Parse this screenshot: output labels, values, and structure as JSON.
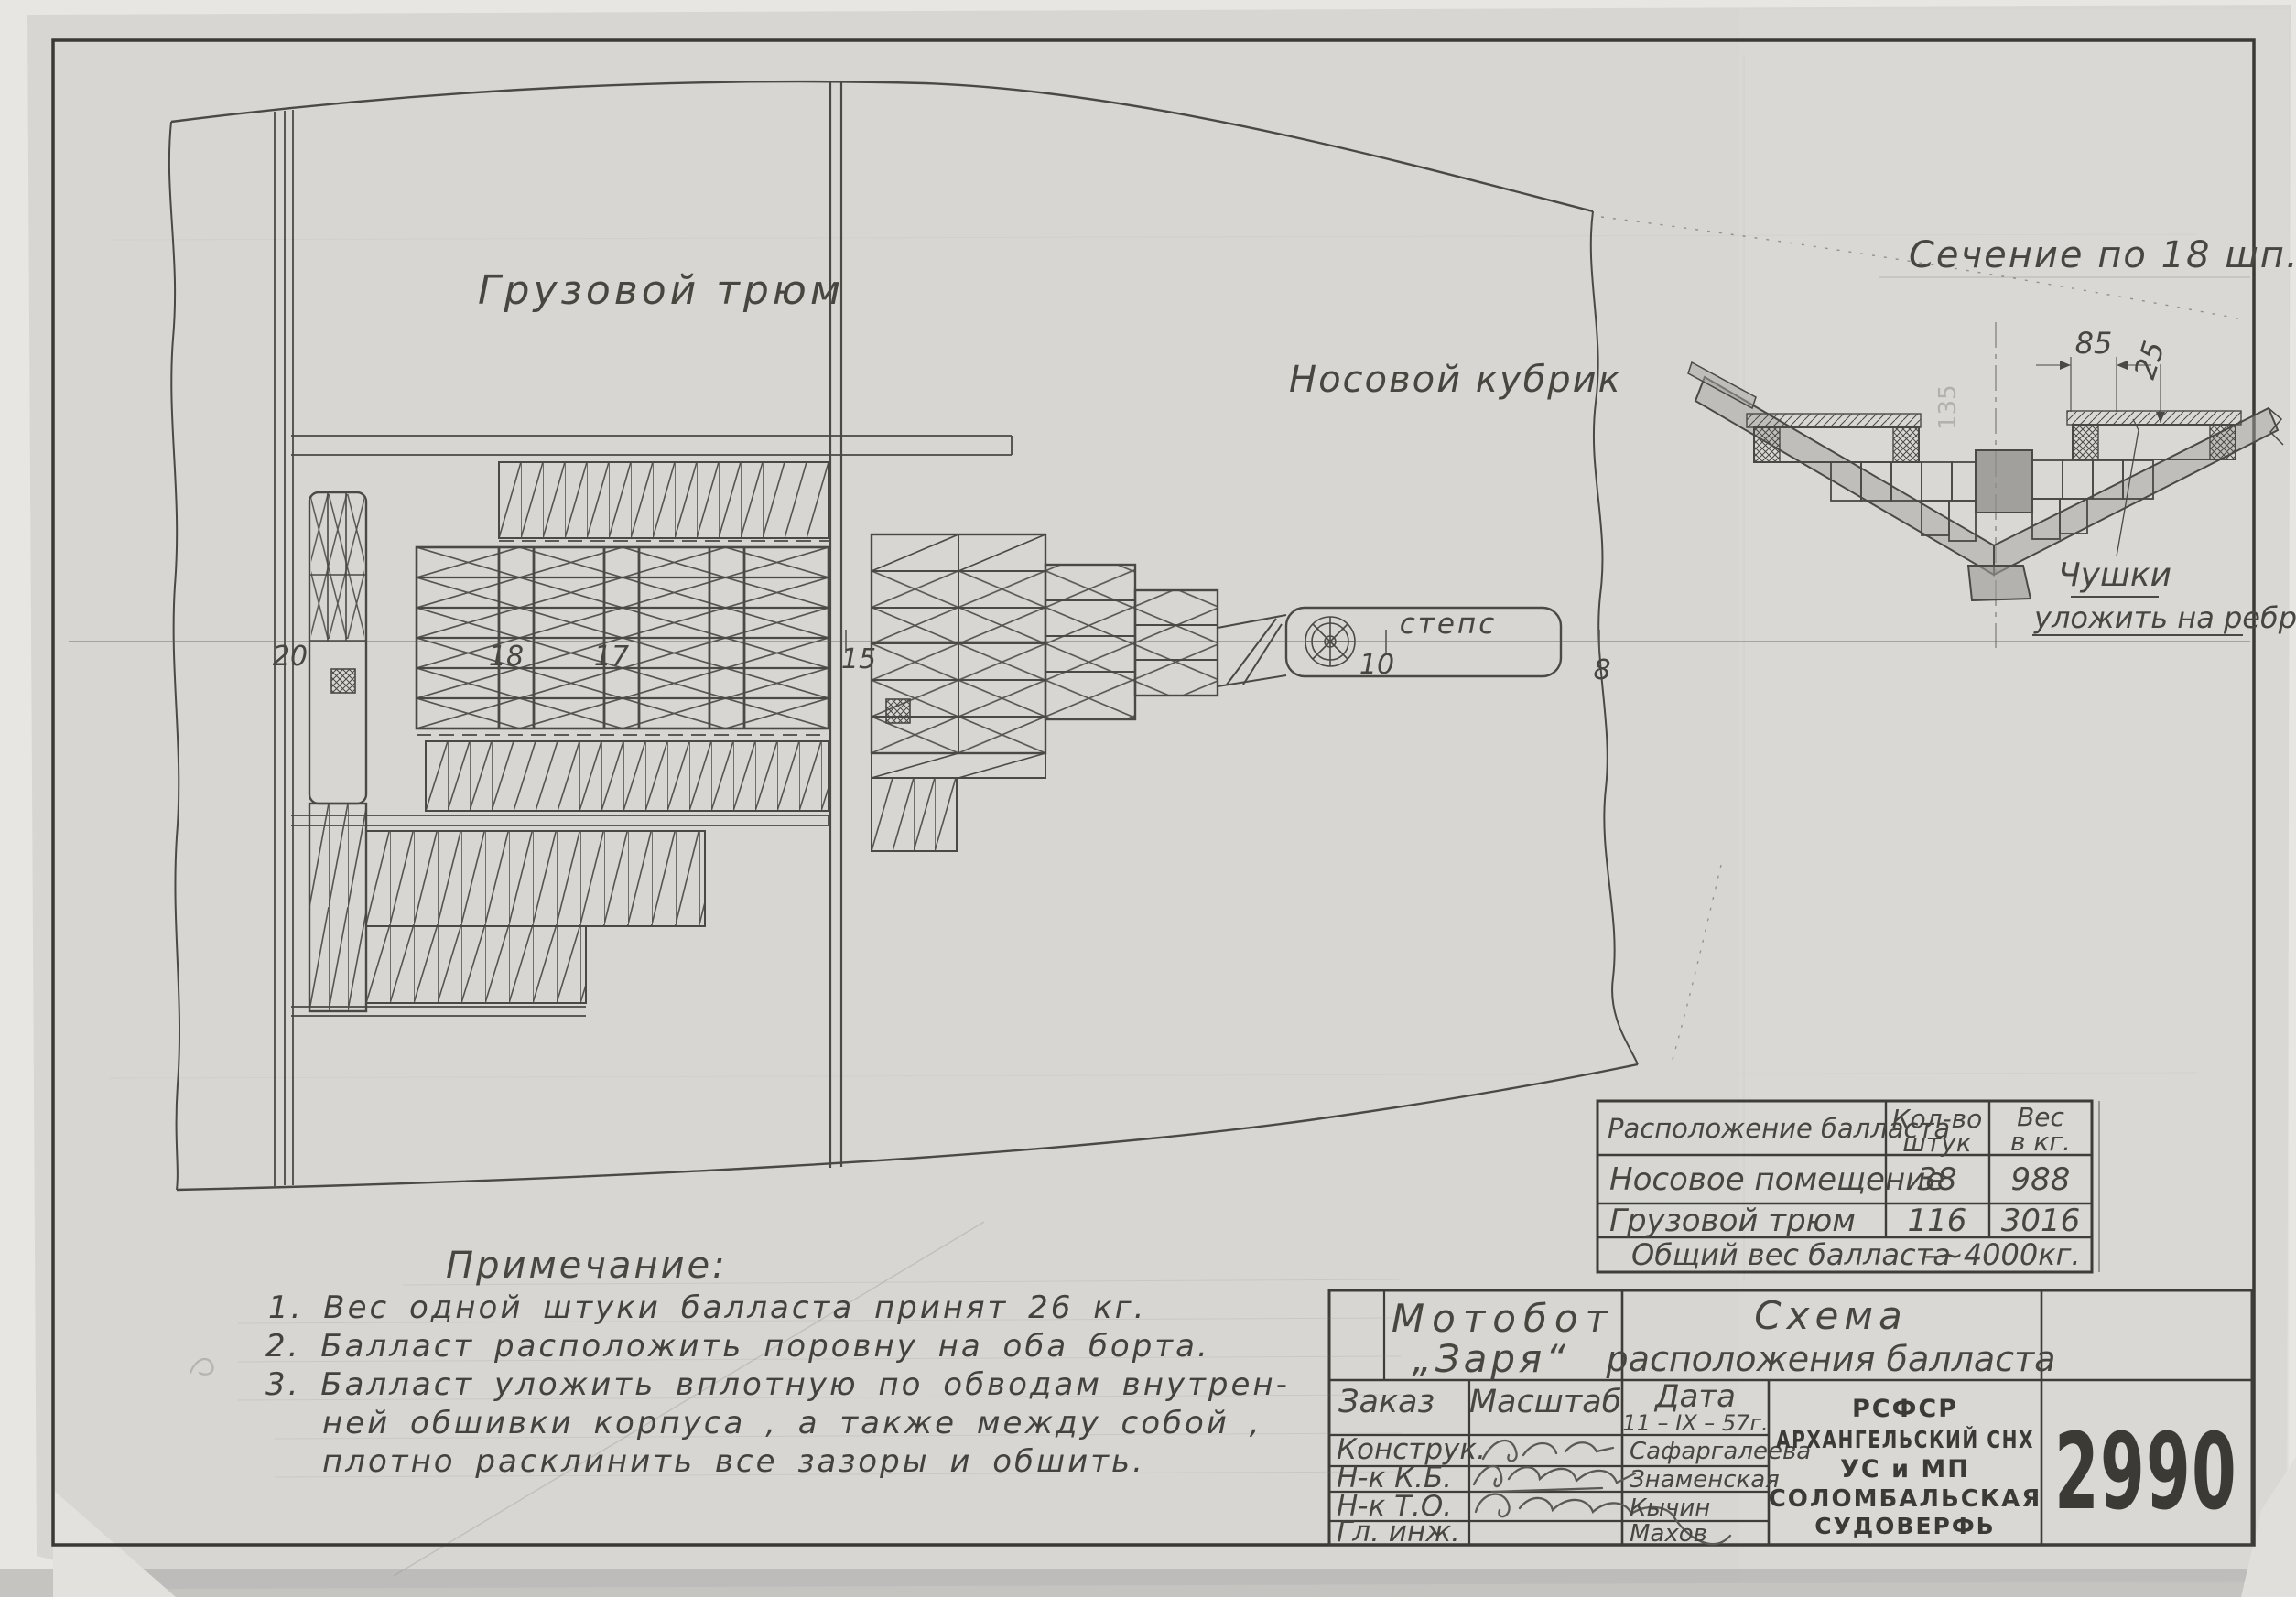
{
  "doc": {
    "labels": {
      "cargo_hold": "Грузовой  трюм",
      "bow_cabin": "Носовой  кубрик",
      "mast_step": "степс",
      "section_title": "Сечение  по  18 шп.",
      "chushki_line1": "Чушки",
      "chushki_line2": "уложить  на ребро",
      "dim_85": "85",
      "dim_25": "25",
      "pencil_dim": "135"
    },
    "frames": [
      "20",
      "18",
      "17",
      "15",
      "10",
      "8"
    ],
    "notes": {
      "title": "Примечание:",
      "line1": "1. Вес  одной  штуки  балласта  принят  26 кг.",
      "line2": "2. Балласт  расположить  поровну  на  оба  борта.",
      "line3a": "3. Балласт  уложить  вплотную  по  обводам  внутрен-",
      "line3b": "ней  обшивки  корпуса , а  также  между  собой ,",
      "line3c": "плотно  расклинить  все  зазоры  и  обшить."
    },
    "table": {
      "col_location": "Расположение  балласта",
      "col_qty_1": "Кол-во",
      "col_qty_2": "штук",
      "col_wt_1": "Вес",
      "col_wt_2": "в кг.",
      "rows": [
        {
          "location": "Носовое  помещение",
          "qty": "38",
          "weight": "988"
        },
        {
          "location": "Грузовой  трюм",
          "qty": "116",
          "weight": "3016"
        }
      ],
      "total_label": "Общий   вес  балласта",
      "total_value": "–~4000кг."
    },
    "title_block": {
      "vessel_line1": "Мотобот",
      "vessel_line2": "„Заря“",
      "title_line1": "Схема",
      "title_line2": "расположения балласта",
      "order_label": "Заказ",
      "scale_label": "Масштаб",
      "date_label": "Дата",
      "date_value": "11 – IX – 57г.",
      "rows": [
        {
          "role": "Конструк.",
          "name": "Сафаргалеева"
        },
        {
          "role": "Н-к  К.Б.",
          "name": "Знаменская"
        },
        {
          "role": "Н-к  Т.О.",
          "name": "Кычин"
        },
        {
          "role": "Гл. инж.",
          "name": "Махов"
        }
      ],
      "org": [
        "РСФСР",
        "АРХАНГЕЛЬСКИЙ СНХ",
        "УС и МП",
        "СОЛОМБАЛЬСКАЯ",
        "СУДОВЕРФЬ"
      ],
      "number": "2990"
    }
  }
}
